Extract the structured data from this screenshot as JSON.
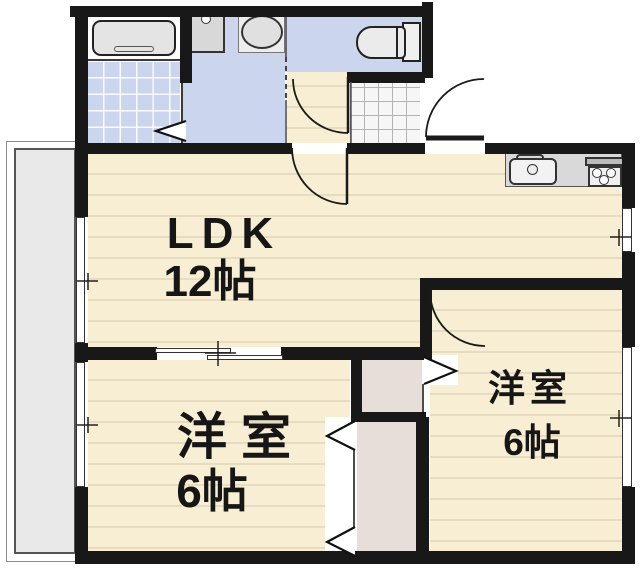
{
  "rooms": {
    "ldk": {
      "label": "LDK",
      "size": "12帖"
    },
    "bedroom_left": {
      "label": "洋室",
      "size": "6帖"
    },
    "bedroom_right": {
      "label": "洋室",
      "size": "6帖"
    }
  },
  "fixtures": {
    "bathtub": "bathtub-icon",
    "washbasin": "washbasin-icon",
    "washing_machine": "washing-machine-icon",
    "toilet": "toilet-icon",
    "kitchen_sink": "kitchen-sink-icon",
    "stove": "stove-icon"
  },
  "colors": {
    "wall": "#181818",
    "wood_floor": "#f8eed3",
    "floor_line": "#e7dcc0",
    "wet_area": "#ccd5ee",
    "closet": "#e8ded9",
    "balcony": "#e9e9e9",
    "counter": "#d9d9d9"
  }
}
